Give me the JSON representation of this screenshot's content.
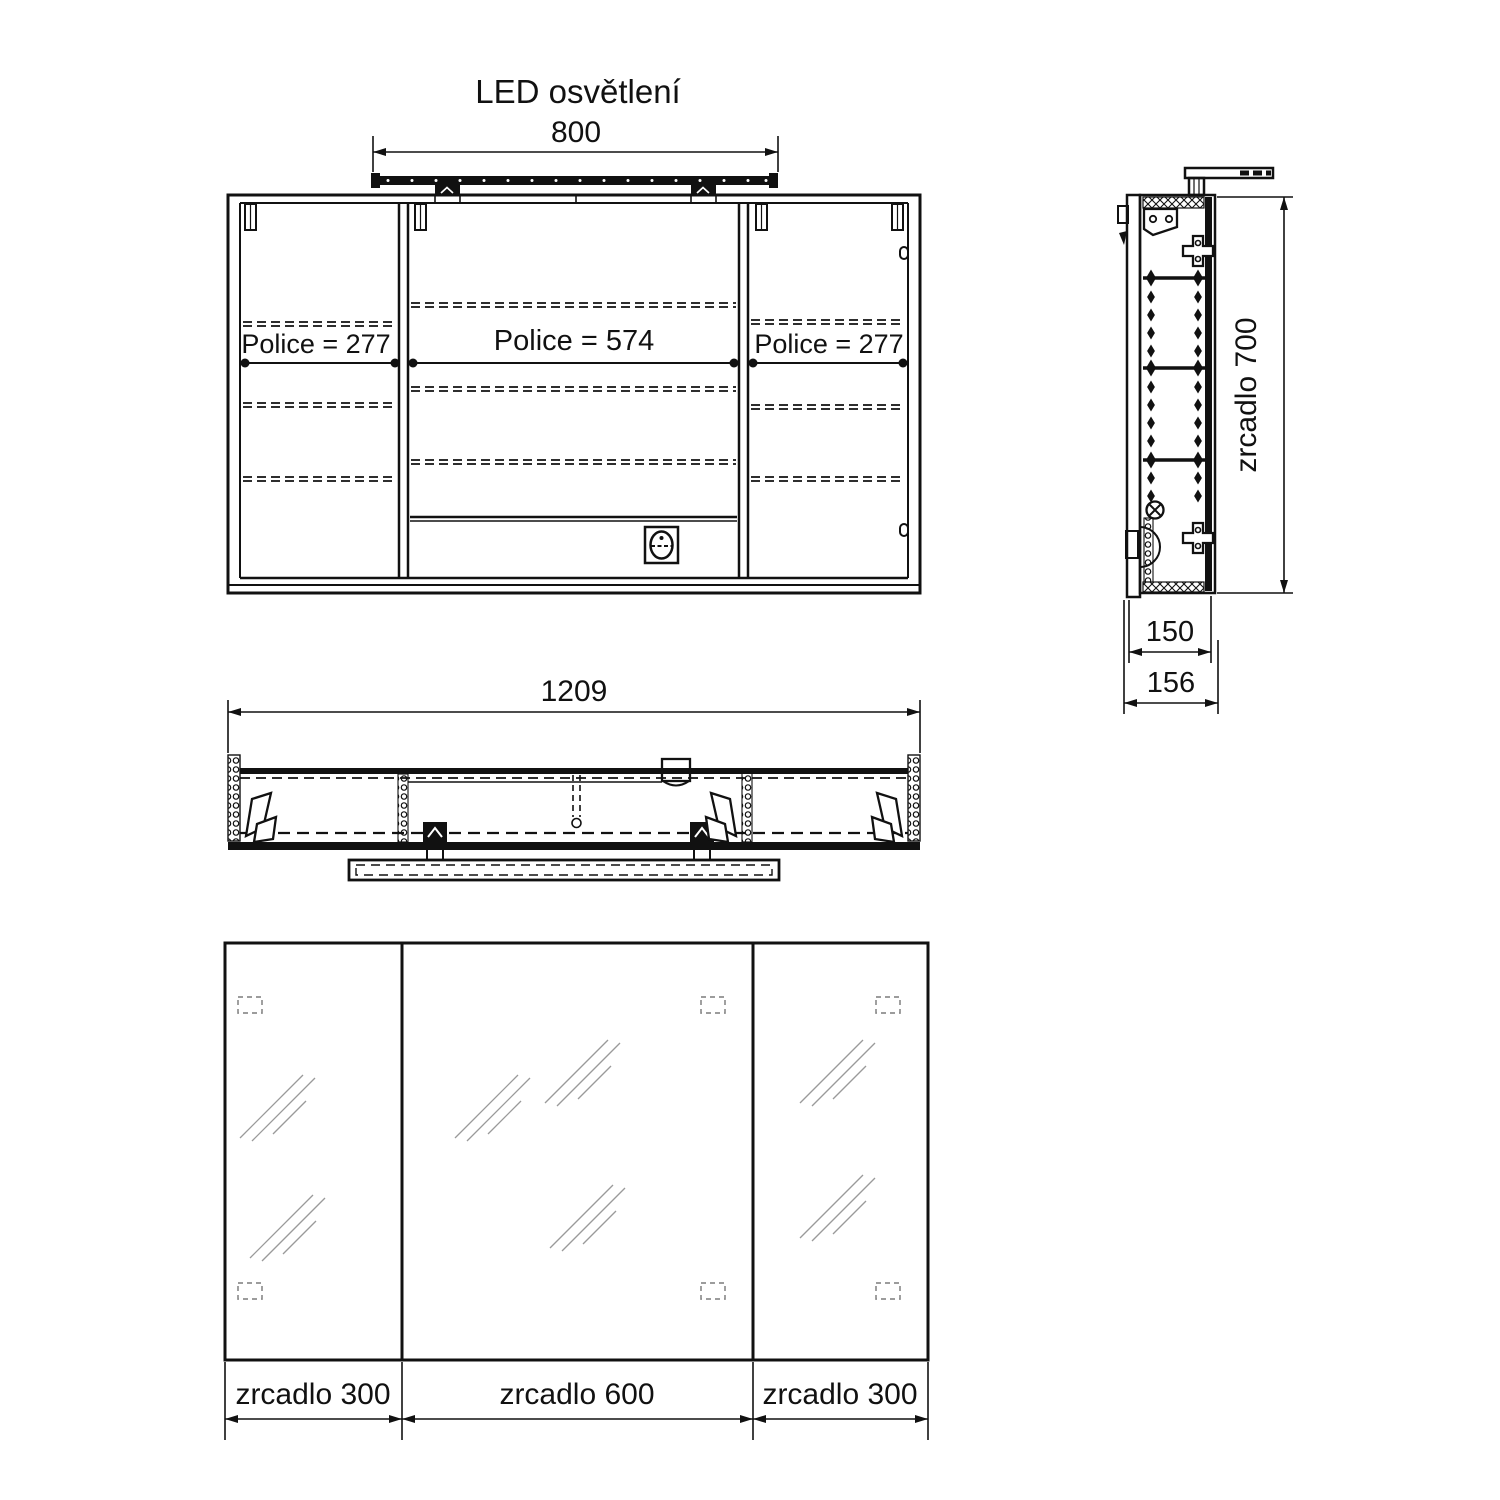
{
  "title": "LED osvětlení",
  "front_view": {
    "led_width": "800",
    "shelf_left": "Police = 277",
    "shelf_center": "Police = 574",
    "shelf_right": "Police = 277"
  },
  "plan_view": {
    "total_width": "1209"
  },
  "side_view": {
    "mirror_height": "zrcadlo 700",
    "depth_body": "150",
    "depth_total": "156"
  },
  "mirror_view": {
    "left": "zrcadlo 300",
    "center": "zrcadlo 600",
    "right": "zrcadlo 300"
  },
  "colors": {
    "line": "#111111",
    "background": "#ffffff",
    "shine": "#999999"
  }
}
